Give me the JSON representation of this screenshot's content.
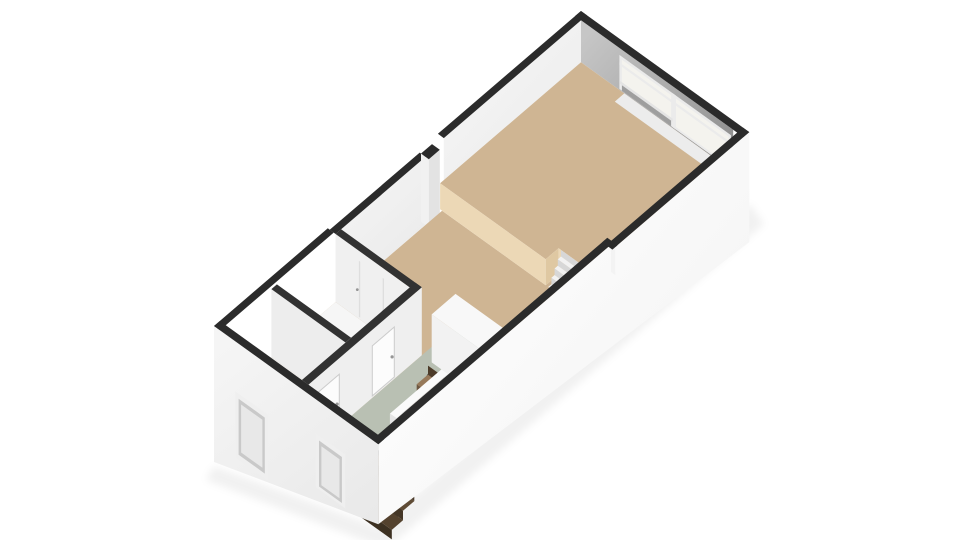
{
  "scene": {
    "type": "3d-floorplan-render",
    "view": "isometric-from-southeast",
    "rooms": [
      {
        "name": "living-room",
        "level": "upper",
        "floor": "tan"
      },
      {
        "name": "lower-living-area",
        "level": "main",
        "floor": "tan"
      },
      {
        "name": "hallway",
        "level": "main",
        "floor": "sage"
      },
      {
        "name": "small-room-a",
        "level": "main",
        "floor": "white"
      },
      {
        "name": "small-room-b",
        "level": "main",
        "floor": "white"
      }
    ],
    "elements": [
      {
        "name": "ne-window-wall",
        "desc": "gray interior wall with white framed window and glass door panel"
      },
      {
        "name": "platform-steps",
        "steps": 4,
        "desc": "white steps from upper living room down to mid level"
      },
      {
        "name": "stairwell",
        "treads": 7,
        "desc": "wooden staircase descending to lower floor"
      },
      {
        "name": "stair-enclosure",
        "desc": "white balustrade wall beside stairwell"
      },
      {
        "name": "closet-block",
        "desc": "white block volume beside stairs"
      },
      {
        "name": "chimney-column",
        "desc": "dark-topped square column on northwest wall"
      },
      {
        "name": "room-a-door",
        "desc": "white interior door with handle"
      },
      {
        "name": "room-b-door",
        "desc": "white interior door with handle"
      },
      {
        "name": "closet-room-b",
        "desc": "built-in closet seams on room B wall"
      },
      {
        "name": "exterior-window-frame",
        "desc": "recessed window of floor below on southwest facade"
      },
      {
        "name": "exterior-door-frame",
        "desc": "recessed entrance door on southwest facade"
      }
    ]
  },
  "colors": {
    "background": "#ffffff",
    "wall_top": "#2b2b2b",
    "wall_top_partition": "#323232",
    "wall_int_light": "#f6f6f6",
    "wall_int_shade": "#e2e2e2",
    "wall_gray_light": "#c3c3c3",
    "wall_gray_dark": "#8d8d8d",
    "wall_ext_light": "#fdfdfd",
    "wall_ext_shade": "#ececec",
    "floor_tan": "#cfb593",
    "floor_tan_face": "#ecd8b6",
    "floor_tan_face2": "#dfc8a2",
    "floor_sage": "#b9c0b3",
    "floor_white": "#f6f6f6",
    "step_white_top": "#f2f2f2",
    "step_white_riser": "#d7d7d7",
    "step_side": "#e6e6e6",
    "wood_light": "#97795a",
    "wood_dark": "#54422e",
    "void_dark": "#3a3a3a",
    "window_frame": "#ebebeb",
    "window_pane": "#f4f3ee",
    "frame_shade": "#c9c9c9",
    "sill": "#e4e4e4",
    "door_leaf": "#fcfcfc",
    "door_edge": "#cccccc",
    "handle": "#969696",
    "column_sw": "#f1f1f1",
    "column_se": "#e3e3e3",
    "shadow": "rgba(0,0,0,0.055)"
  }
}
